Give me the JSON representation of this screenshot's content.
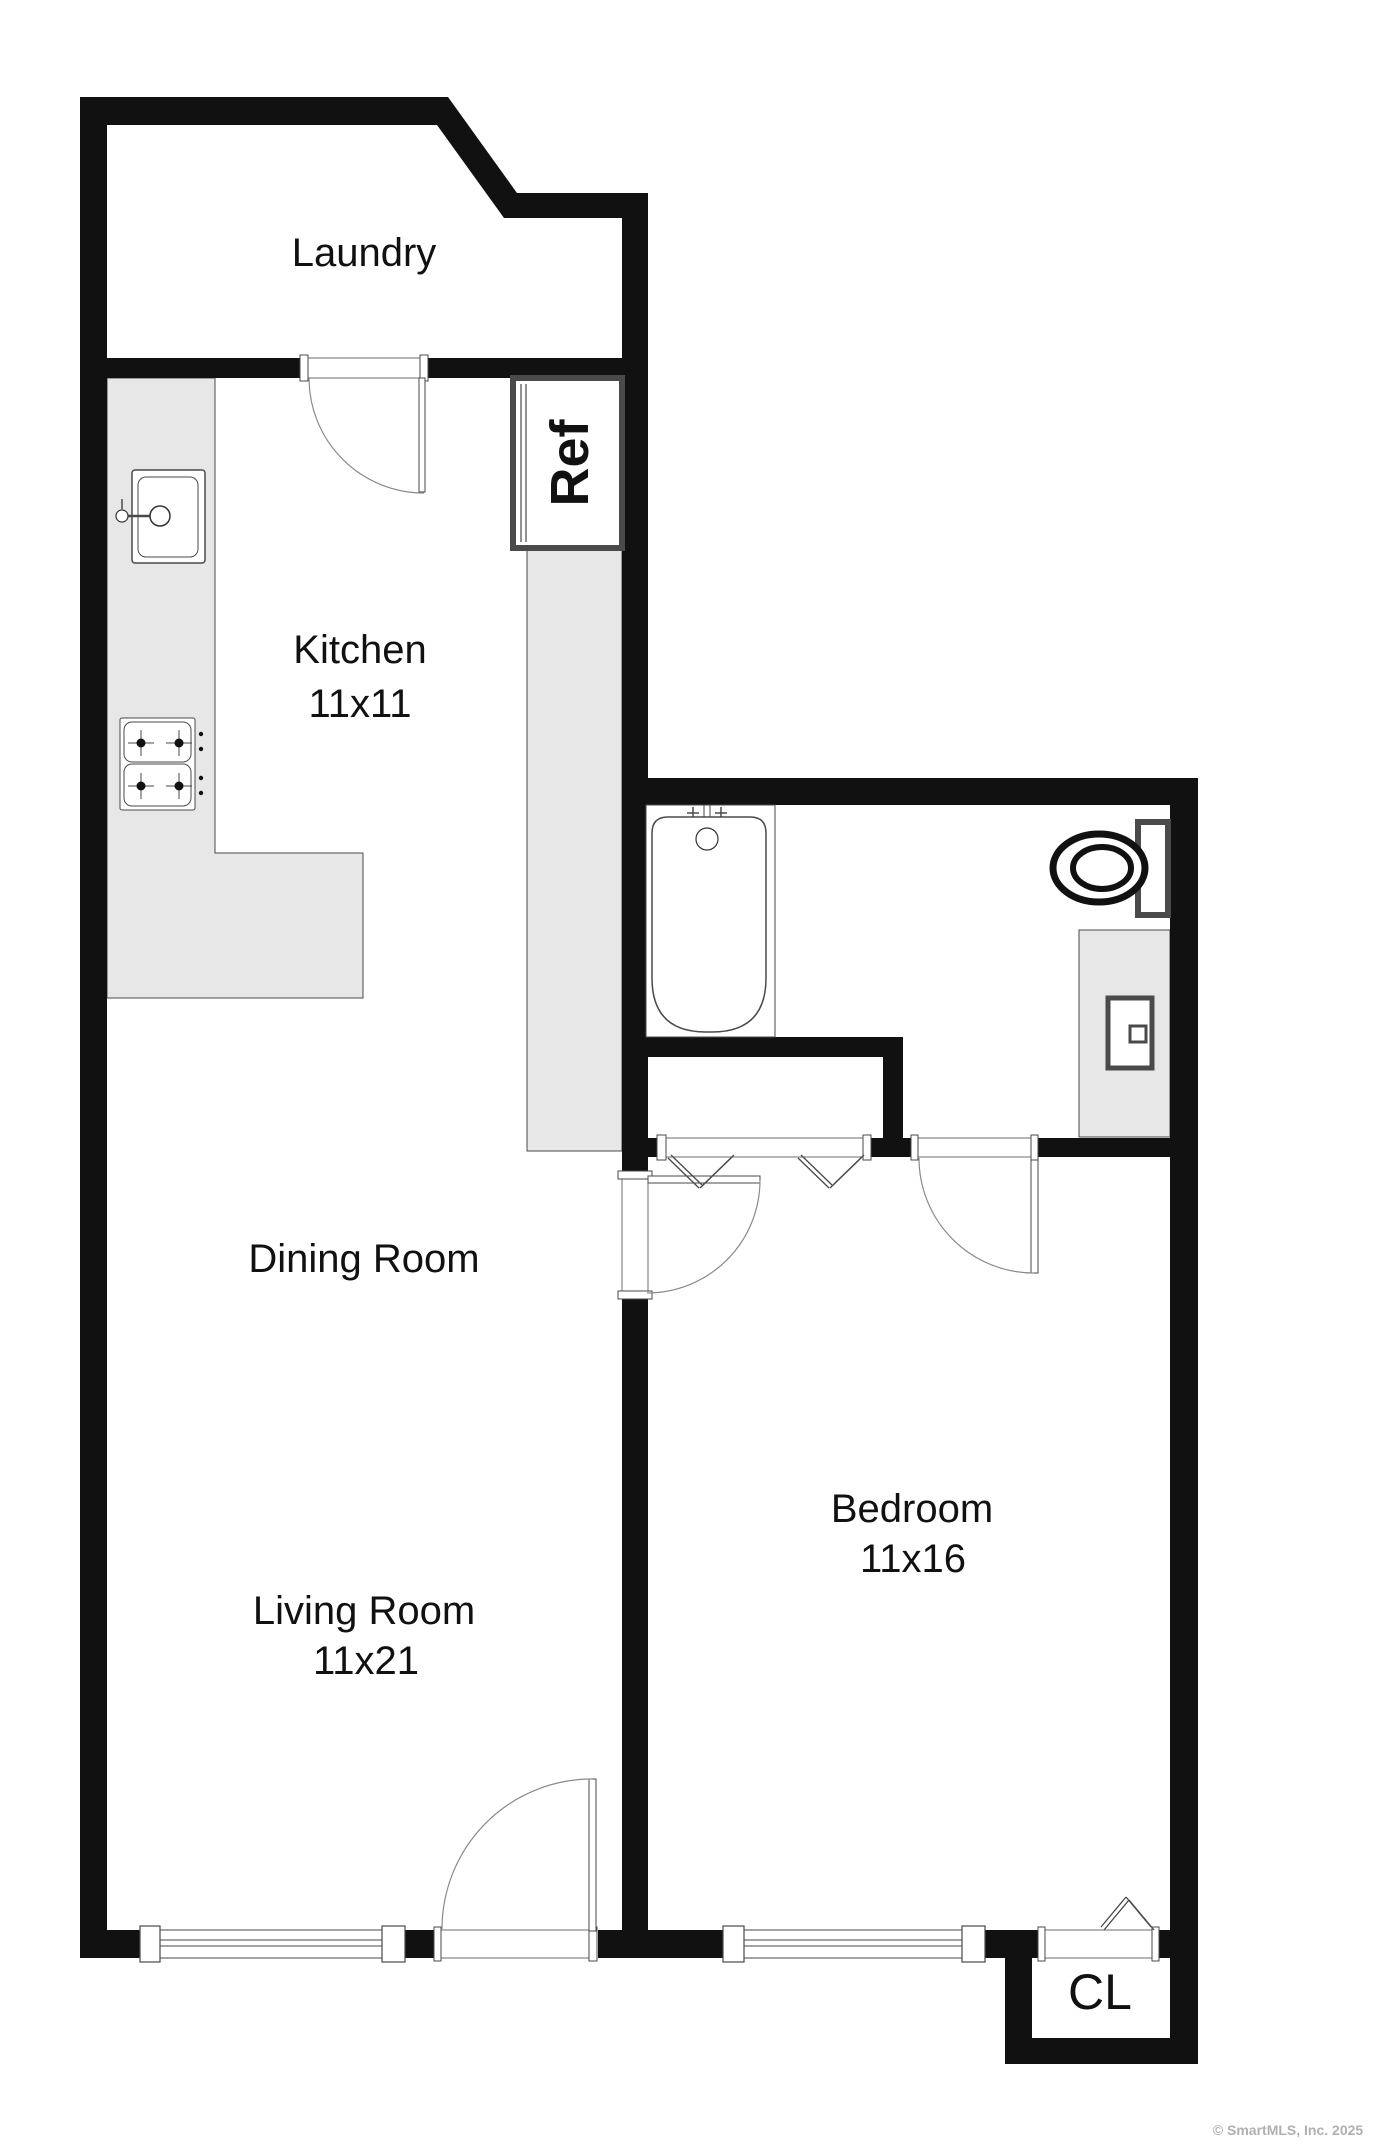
{
  "document": {
    "type": "real-estate floor plan",
    "watermark": "© SmartMLS, Inc.  2025",
    "watermark_color": "#b0b0b0"
  },
  "rooms": [
    {
      "id": "laundry",
      "label": "Laundry",
      "size": ""
    },
    {
      "id": "kitchen",
      "label": "Kitchen",
      "size": "11x11"
    },
    {
      "id": "dining",
      "label": "Dining Room",
      "size": ""
    },
    {
      "id": "living",
      "label": "Living Room",
      "size": "11x21"
    },
    {
      "id": "bedroom",
      "label": "Bedroom",
      "size": "11x16"
    },
    {
      "id": "closet",
      "label": "CL",
      "size": ""
    },
    {
      "id": "refrigerator",
      "label": "Ref",
      "size": ""
    }
  ],
  "style": {
    "wall": "#111111",
    "line": "#4a4a4a",
    "arc": "#8a8a8a",
    "area": "#e7e7e7",
    "text": "#111111",
    "bg": "#ffffff"
  },
  "plan": {
    "width": 1379,
    "height": 2148,
    "wall_polygons": [
      {
        "name": "wall-diagonal-laundry",
        "pts": "448,97 517,193 504,218 437,125"
      }
    ],
    "walls": [
      {
        "name": "wall-top",
        "r": [
          80,
          97,
          368,
          28
        ]
      },
      {
        "name": "wall-left",
        "r": [
          80,
          97,
          27,
          1861
        ]
      },
      {
        "name": "wall-top-right",
        "r": [
          504,
          193,
          144,
          25
        ]
      },
      {
        "name": "wall-divider-upper",
        "r": [
          622,
          193,
          26,
          985
        ]
      },
      {
        "name": "wall-divider-lower",
        "r": [
          622,
          1293,
          26,
          665
        ]
      },
      {
        "name": "wall-laundry-bottom-left",
        "r": [
          107,
          358,
          193,
          20
        ]
      },
      {
        "name": "wall-laundry-bottom-right",
        "r": [
          428,
          358,
          194,
          20
        ]
      },
      {
        "name": "wall-bathroom-top",
        "r": [
          622,
          778,
          576,
          27
        ]
      },
      {
        "name": "wall-right",
        "r": [
          1170,
          778,
          28,
          1286
        ]
      },
      {
        "name": "wall-tub-bottom",
        "r": [
          622,
          1037,
          281,
          20
        ]
      },
      {
        "name": "wall-closet-right",
        "r": [
          883,
          1057,
          20,
          100
        ]
      },
      {
        "name": "wall-bedroom-top-a",
        "r": [
          646,
          1138,
          12,
          19
        ]
      },
      {
        "name": "wall-bedroom-top-b",
        "r": [
          870,
          1138,
          47,
          19
        ]
      },
      {
        "name": "wall-bedroom-top-c",
        "r": [
          1038,
          1138,
          132,
          19
        ]
      },
      {
        "name": "wall-bottom-a",
        "r": [
          80,
          1930,
          60,
          28
        ]
      },
      {
        "name": "wall-bottom-b",
        "r": [
          405,
          1930,
          29,
          28
        ]
      },
      {
        "name": "wall-bottom-c",
        "r": [
          598,
          1930,
          125,
          28
        ]
      },
      {
        "name": "wall-bottom-d",
        "r": [
          985,
          1930,
          54,
          28
        ]
      },
      {
        "name": "wall-bottom-e",
        "r": [
          1159,
          1930,
          39,
          28
        ]
      },
      {
        "name": "wall-cl-left",
        "r": [
          1005,
          1958,
          27,
          106
        ]
      },
      {
        "name": "wall-cl-bottom",
        "r": [
          1005,
          2038,
          193,
          26
        ]
      }
    ],
    "gray_areas": [
      {
        "name": "kitchen-counter",
        "pts": "107,378 215,378 215,853 363,853 363,998 107,998"
      },
      {
        "name": "pantry-counter",
        "pts": "527,548 622,548 622,1151 527,1151"
      },
      {
        "name": "bathroom-vanity",
        "pts": "1079,930 1170,930 1170,1137 1079,1137"
      }
    ],
    "boxes": [
      {
        "name": "tub-alcove",
        "x": 646,
        "y": 805,
        "w": 129,
        "h": 232,
        "sw": 1
      },
      {
        "name": "refrigerator-box",
        "x": 513,
        "y": 378,
        "w": 109,
        "h": 170,
        "sw": 6
      },
      {
        "name": "laundry-door-opening",
        "x": 307,
        "y": 358,
        "w": 114,
        "h": 20,
        "sw": 0.8
      },
      {
        "name": "laundry-door-post-left",
        "x": 300,
        "y": 355,
        "w": 8,
        "h": 26,
        "sw": 1
      },
      {
        "name": "laundry-door-post-right",
        "x": 420,
        "y": 355,
        "w": 8,
        "h": 26,
        "sw": 1
      },
      {
        "name": "laundry-door-leaf",
        "x": 419,
        "y": 378,
        "w": 6,
        "h": 114,
        "sw": 1
      },
      {
        "name": "dining-door-opening",
        "x": 622,
        "y": 1178,
        "w": 26,
        "h": 115,
        "sw": 0.8
      },
      {
        "name": "dining-door-post-top",
        "x": 618,
        "y": 1171,
        "w": 34,
        "h": 8,
        "sw": 1
      },
      {
        "name": "dining-door-post-bottom",
        "x": 618,
        "y": 1291,
        "w": 34,
        "h": 8,
        "sw": 1
      },
      {
        "name": "dining-door-leaf",
        "x": 648,
        "y": 1176,
        "w": 112,
        "h": 7,
        "sw": 1
      },
      {
        "name": "bathroom-door-opening",
        "x": 917,
        "y": 1138,
        "w": 115,
        "h": 19,
        "sw": 0.8
      },
      {
        "name": "bathroom-door-post-left",
        "x": 911,
        "y": 1135,
        "w": 7,
        "h": 25,
        "sw": 1
      },
      {
        "name": "bathroom-door-post-right",
        "x": 1031,
        "y": 1135,
        "w": 7,
        "h": 25,
        "sw": 1
      },
      {
        "name": "bathroom-door-leaf",
        "x": 1031,
        "y": 1160,
        "w": 7,
        "h": 113,
        "sw": 1
      },
      {
        "name": "entry-door-opening",
        "x": 440,
        "y": 1930,
        "w": 150,
        "h": 28,
        "sw": 0.8
      },
      {
        "name": "entry-door-post-left",
        "x": 434,
        "y": 1927,
        "w": 7,
        "h": 34,
        "sw": 1
      },
      {
        "name": "entry-door-post-right",
        "x": 589,
        "y": 1927,
        "w": 8,
        "h": 34,
        "sw": 1
      },
      {
        "name": "entry-door-leaf",
        "x": 589,
        "y": 1779,
        "w": 7,
        "h": 152,
        "sw": 1
      },
      {
        "name": "bifold-closet-opening",
        "x": 666,
        "y": 1138,
        "w": 197,
        "h": 19,
        "sw": 0.8
      },
      {
        "name": "bifold-post-left",
        "x": 657,
        "y": 1135,
        "w": 9,
        "h": 25,
        "sw": 1
      },
      {
        "name": "bifold-post-right",
        "x": 863,
        "y": 1135,
        "w": 8,
        "h": 25,
        "sw": 1
      },
      {
        "name": "cl-door-opening",
        "x": 1044,
        "y": 1930,
        "w": 109,
        "h": 28,
        "sw": 0.8
      },
      {
        "name": "cl-door-post-left",
        "x": 1038,
        "y": 1927,
        "w": 7,
        "h": 34,
        "sw": 1
      },
      {
        "name": "cl-door-post-right",
        "x": 1152,
        "y": 1927,
        "w": 7,
        "h": 34,
        "sw": 1
      },
      {
        "name": "living-window",
        "x": 160,
        "y": 1930,
        "w": 222,
        "h": 28,
        "sw": 1
      },
      {
        "name": "living-window-post-left",
        "x": 140,
        "y": 1926,
        "w": 20,
        "h": 36,
        "sw": 1.2
      },
      {
        "name": "living-window-post-right",
        "x": 382,
        "y": 1926,
        "w": 23,
        "h": 36,
        "sw": 1.2
      },
      {
        "name": "bedroom-window",
        "x": 744,
        "y": 1930,
        "w": 218,
        "h": 28,
        "sw": 1
      },
      {
        "name": "bedroom-window-post-left",
        "x": 723,
        "y": 1926,
        "w": 21,
        "h": 36,
        "sw": 1.2
      },
      {
        "name": "bedroom-window-post-right",
        "x": 962,
        "y": 1926,
        "w": 23,
        "h": 36,
        "sw": 1.2
      },
      {
        "name": "toilet-tank",
        "x": 1138,
        "y": 822,
        "w": 30,
        "h": 93,
        "sw": 6
      },
      {
        "name": "vanity-sink",
        "x": 1108,
        "y": 998,
        "w": 44,
        "h": 70,
        "sw": 5
      },
      {
        "name": "vanity-sink-knob",
        "x": 1130,
        "y": 1026,
        "w": 16,
        "h": 16,
        "sw": 3
      },
      {
        "name": "kitchen-sink-outer",
        "x": 132,
        "y": 470,
        "w": 73,
        "h": 93,
        "sw": 1.5,
        "rx": 3
      },
      {
        "name": "kitchen-sink-inner",
        "x": 138,
        "y": 477,
        "w": 60,
        "h": 80,
        "sw": 1,
        "rx": 8
      },
      {
        "name": "stove-outer",
        "x": 120,
        "y": 718,
        "w": 75,
        "h": 92,
        "sw": 1,
        "rx": 2
      },
      {
        "name": "stove-cell-top",
        "x": 124,
        "y": 722,
        "w": 67,
        "h": 40,
        "sw": 1,
        "rx": 8
      },
      {
        "name": "stove-cell-bottom",
        "x": 124,
        "y": 764,
        "w": 67,
        "h": 42,
        "sw": 1,
        "rx": 8
      }
    ],
    "paths": [
      {
        "name": "bathtub",
        "d": "M 668 817 H 750 Q 766 817 766 833 V 978 Q 766 1032 712 1032 H 706 Q 652 1032 652 978 V 833 Q 652 817 668 817 Z",
        "sw": 1.5,
        "fill": "#ffffff"
      },
      {
        "name": "laundry-door-arc",
        "d": "M 309 378 A 115 115 0 0 0 424 493",
        "sw": 1.2,
        "c": "#8a8a8a"
      },
      {
        "name": "dining-door-arc",
        "d": "M 760 1180 A 113 113 0 0 1 647 1293",
        "sw": 1.2,
        "c": "#8a8a8a"
      },
      {
        "name": "bathroom-door-arc",
        "d": "M 919 1158 A 115 115 0 0 0 1034 1273",
        "sw": 1.2,
        "c": "#8a8a8a"
      },
      {
        "name": "entry-door-arc",
        "d": "M 442 1929 A 150 150 0 0 1 592 1779",
        "sw": 1.2,
        "c": "#8a8a8a"
      }
    ],
    "lines": [
      [
        160,
        1940,
        382,
        1940,
        1
      ],
      [
        160,
        1946,
        382,
        1946,
        1
      ],
      [
        744,
        1940,
        962,
        1940,
        1
      ],
      [
        744,
        1946,
        962,
        1946,
        1
      ],
      [
        521,
        384,
        521,
        542,
        1.2
      ],
      [
        526,
        384,
        526,
        542,
        1.2
      ],
      [
        704,
        805,
        704,
        829,
        1
      ],
      [
        710,
        805,
        710,
        829,
        1
      ],
      [
        687,
        813,
        699,
        813,
        1.5
      ],
      [
        693,
        807,
        693,
        819,
        1.5
      ],
      [
        715,
        813,
        727,
        813,
        1.5
      ],
      [
        721,
        807,
        721,
        819,
        1.5
      ],
      [
        126,
        516,
        152,
        516,
        2.5
      ],
      [
        122,
        499,
        122,
        509,
        1.5
      ],
      [
        128,
        743,
        154,
        743,
        1
      ],
      [
        141,
        730,
        141,
        756,
        1
      ],
      [
        166,
        743,
        192,
        743,
        1
      ],
      [
        179,
        730,
        179,
        756,
        1
      ],
      [
        128,
        786,
        154,
        786,
        1
      ],
      [
        141,
        773,
        141,
        799,
        1
      ],
      [
        166,
        786,
        192,
        786,
        1
      ],
      [
        179,
        773,
        179,
        799,
        1
      ],
      [
        668,
        1158,
        699,
        1188,
        1.3
      ],
      [
        671,
        1155,
        702,
        1185,
        1.3
      ],
      [
        700,
        1188,
        731,
        1158,
        1.3
      ],
      [
        703,
        1185,
        734,
        1155,
        1.3
      ],
      [
        798,
        1158,
        829,
        1188,
        1.3
      ],
      [
        801,
        1155,
        832,
        1185,
        1.3
      ],
      [
        830,
        1188,
        861,
        1158,
        1.3
      ],
      [
        833,
        1185,
        864,
        1155,
        1.3
      ],
      [
        1101,
        1927,
        1126,
        1897,
        1.3
      ],
      [
        1104,
        1930,
        1129,
        1900,
        1.3
      ],
      [
        1126,
        1897,
        1151,
        1927,
        1.3
      ],
      [
        1129,
        1900,
        1154,
        1930,
        1.3
      ]
    ],
    "circles": [
      {
        "name": "tub-drain",
        "x": 707,
        "y": 839,
        "r": 11,
        "sw": 1.2
      },
      {
        "name": "kitchen-faucet-handle",
        "x": 122,
        "y": 516,
        "r": 6,
        "sw": 1.2
      },
      {
        "name": "kitchen-faucet-head",
        "x": 160,
        "y": 516,
        "r": 10,
        "sw": 1.5
      },
      {
        "name": "stove-burner",
        "x": 141,
        "y": 743,
        "r": 4.5,
        "f": true
      },
      {
        "name": "stove-burner",
        "x": 179,
        "y": 743,
        "r": 4.5,
        "f": true
      },
      {
        "name": "stove-burner",
        "x": 141,
        "y": 786,
        "r": 4.5,
        "f": true
      },
      {
        "name": "stove-burner",
        "x": 179,
        "y": 786,
        "r": 4.5,
        "f": true
      },
      {
        "name": "stove-knob",
        "x": 201,
        "y": 734,
        "r": 2.2,
        "f": true
      },
      {
        "name": "stove-knob",
        "x": 201,
        "y": 749,
        "r": 2.2,
        "f": true
      },
      {
        "name": "stove-knob",
        "x": 201,
        "y": 778,
        "r": 2.2,
        "f": true
      },
      {
        "name": "stove-knob",
        "x": 201,
        "y": 793,
        "r": 2.2,
        "f": true
      }
    ],
    "ellipses": [
      {
        "name": "toilet-bowl-outer",
        "x": 1099,
        "y": 868,
        "rx": 46,
        "ry": 34,
        "sw": 7,
        "fill": "#ffffff"
      },
      {
        "name": "toilet-bowl-inner",
        "x": 1102,
        "y": 868,
        "rx": 29,
        "ry": 21,
        "sw": 6,
        "fill": "none"
      }
    ]
  },
  "labels": [
    {
      "id": "laundry",
      "text": "Laundry",
      "x": 364,
      "y": 253,
      "size": 40
    },
    {
      "id": "kitchen",
      "text": "Kitchen",
      "x": 360,
      "y": 650,
      "size": 40
    },
    {
      "id": "kitchen-size",
      "text": "11x11",
      "x": 360,
      "y": 704,
      "size": 40
    },
    {
      "id": "ref",
      "text": "Ref",
      "x": 570,
      "y": 463,
      "size": 54,
      "rot": -90,
      "weight": 600
    },
    {
      "id": "dining",
      "text": "Dining Room",
      "x": 364,
      "y": 1259,
      "size": 40
    },
    {
      "id": "living",
      "text": "Living Room",
      "x": 364,
      "y": 1611,
      "size": 40
    },
    {
      "id": "living-size",
      "text": "11x21",
      "x": 366,
      "y": 1661,
      "size": 40
    },
    {
      "id": "bedroom",
      "text": "Bedroom",
      "x": 912,
      "y": 1509,
      "size": 40
    },
    {
      "id": "bedroom-size",
      "text": "11x16",
      "x": 913,
      "y": 1559,
      "size": 40
    },
    {
      "id": "cl",
      "text": "CL",
      "x": 1100,
      "y": 1992,
      "size": 50
    },
    {
      "id": "watermark",
      "text": "© SmartMLS, Inc.  2025",
      "x": 1288,
      "y": 2130,
      "size": 14,
      "weight": 700,
      "color": "#b0b0b0"
    }
  ]
}
